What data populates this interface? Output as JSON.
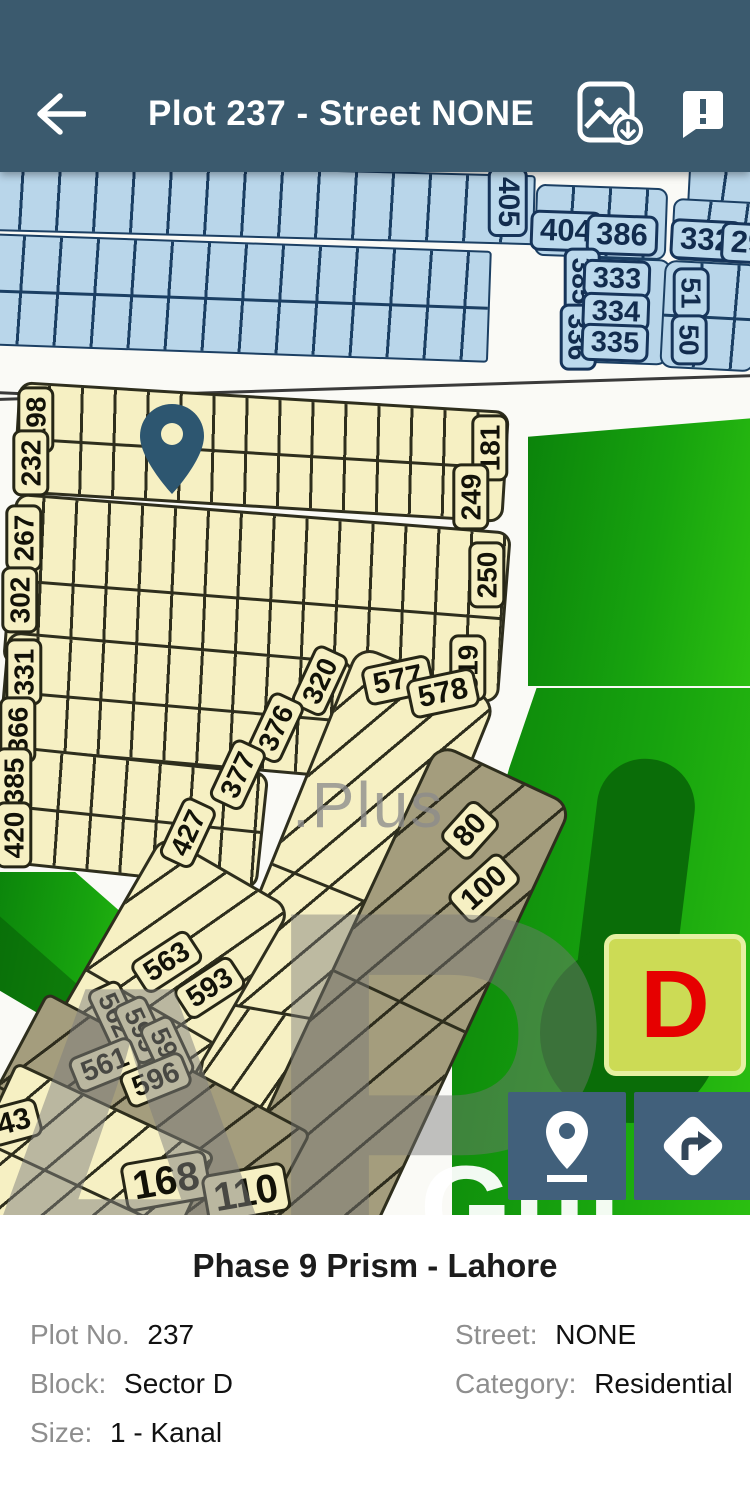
{
  "header": {
    "title": "Plot 237 - Street NONE",
    "icons": [
      "back-arrow",
      "save-map-image",
      "feedback"
    ]
  },
  "colors": {
    "appbar": "#3b5a6e",
    "blue_plot": "#b9d6ea",
    "cream_plot": "#f6f0c3",
    "grey_plot": "#a49d7d",
    "green_area": "#17a30e",
    "badge_bg": "#ccdb55",
    "badge_letter": "#e60000",
    "pin": "#2d5670",
    "button_bg": "#41607b"
  },
  "map": {
    "pin_color": "#2d5670",
    "watermark": {
      "letter_a": "A",
      "letter_p": "P",
      "text": ".Plus"
    },
    "green_area_text": "Gul",
    "sector_badge": {
      "label": "D"
    },
    "buttons": [
      {
        "name": "show-my-location",
        "icon": "map-pin-icon"
      },
      {
        "name": "directions",
        "icon": "turn-right-sign-icon"
      }
    ],
    "bands": [
      {
        "k": "blue",
        "x": -15,
        "y": -4,
        "w": 550,
        "h": 70,
        "rot": 1.5,
        "s": 92,
        "r": 4
      },
      {
        "k": "blue",
        "x": 688,
        "y": -6,
        "w": 70,
        "h": 46,
        "rot": 3,
        "s": 95,
        "r": 4
      },
      {
        "k": "blue",
        "x": 535,
        "y": 14,
        "w": 132,
        "h": 72,
        "rot": 2,
        "s": 92,
        "r": 10
      },
      {
        "k": "blue",
        "x": 672,
        "y": 28,
        "w": 85,
        "h": 62,
        "rot": 3,
        "s": 95,
        "r": 10
      },
      {
        "k": "blue",
        "x": -15,
        "y": 70,
        "w": 505,
        "h": 112,
        "rot": 2,
        "s": 92,
        "r": 4,
        "div": true
      },
      {
        "k": "blue",
        "x": 575,
        "y": 86,
        "w": 95,
        "h": 106,
        "rot": 2,
        "r": 12
      },
      {
        "k": "blue",
        "x": 662,
        "y": 90,
        "w": 95,
        "h": 108,
        "rot": 3,
        "s": 92,
        "r": 12,
        "div": true
      },
      {
        "k": "line",
        "x": -5,
        "y": 214,
        "w": 765,
        "h": 3,
        "rot": -1.8
      },
      {
        "k": "line",
        "x": -5,
        "y": 226,
        "w": 320,
        "h": 3,
        "rot": 2.5
      },
      {
        "k": "cream",
        "x": 15,
        "y": 224,
        "w": 492,
        "h": 112,
        "rot": 3.5,
        "s": 88,
        "r": 14,
        "div": true
      },
      {
        "k": "cream",
        "x": 8,
        "y": 340,
        "w": 498,
        "h": 172,
        "rot": 4.5,
        "s": 88,
        "r": 14,
        "div": true
      },
      {
        "k": "cream",
        "x": 2,
        "y": 474,
        "w": 348,
        "h": 118,
        "rot": 5,
        "s": 88,
        "r": 14,
        "div": true
      },
      {
        "k": "cream",
        "x": -8,
        "y": 586,
        "w": 272,
        "h": 118,
        "rot": 6,
        "s": 88,
        "r": 14,
        "div": true
      },
      {
        "k": "cream",
        "x": 265,
        "y": 483,
        "w": 150,
        "h": 470,
        "rot": 22,
        "s": 118,
        "r": 20,
        "div": true
      },
      {
        "k": "cream",
        "x": 190,
        "y": 838,
        "w": 140,
        "h": 240,
        "rot": 10,
        "s": 115,
        "r": 18,
        "div": true
      },
      {
        "k": "cream",
        "x": 75,
        "y": 678,
        "w": 150,
        "h": 310,
        "rot": 30,
        "s": 115,
        "r": 18,
        "div": true
      },
      {
        "k": "grey",
        "x": 325,
        "y": 578,
        "w": 150,
        "h": 500,
        "rot": 25,
        "s": 115,
        "r": 20,
        "div": true
      },
      {
        "k": "grey",
        "x": -20,
        "y": 878,
        "w": 300,
        "h": 210,
        "rot": 28,
        "s": 115,
        "r": 8,
        "div": true
      },
      {
        "k": "cream",
        "x": -30,
        "y": 928,
        "w": 220,
        "h": 170,
        "rot": 25,
        "s": 115,
        "r": 8,
        "div": true
      }
    ],
    "plots": [
      {
        "t": "405",
        "k": "blue",
        "x": 508,
        "y": 30,
        "rot": 90,
        "fs": 30
      },
      {
        "t": "404",
        "k": "blue",
        "x": 566,
        "y": 59,
        "rot": 2
      },
      {
        "t": "386",
        "k": "blue",
        "x": 622,
        "y": 63,
        "rot": 2
      },
      {
        "t": "332",
        "k": "blue",
        "x": 706,
        "y": 68,
        "rot": 3
      },
      {
        "t": "29",
        "k": "blue",
        "x": 748,
        "y": 71,
        "rot": 3
      },
      {
        "t": "385",
        "k": "blue",
        "x": 582,
        "y": 109,
        "rot": 90,
        "fs": 28
      },
      {
        "t": "336",
        "k": "blue",
        "x": 578,
        "y": 165,
        "rot": 90,
        "fs": 28
      },
      {
        "t": "333",
        "k": "blue",
        "x": 617,
        "y": 107,
        "rot": 2,
        "fs": 29
      },
      {
        "t": "334",
        "k": "blue",
        "x": 616,
        "y": 140,
        "rot": 2,
        "fs": 29
      },
      {
        "t": "335",
        "k": "blue",
        "x": 615,
        "y": 171,
        "rot": 2,
        "fs": 29
      },
      {
        "t": "51",
        "k": "blue",
        "x": 691,
        "y": 121,
        "rot": 90,
        "fs": 28
      },
      {
        "t": "50",
        "k": "blue",
        "x": 689,
        "y": 168,
        "rot": 90,
        "fs": 28
      },
      {
        "t": "198",
        "k": "cream",
        "x": 36,
        "y": 248,
        "rot": -90,
        "fs": 28
      },
      {
        "t": "232",
        "k": "cream",
        "x": 31,
        "y": 291,
        "rot": -90,
        "fs": 28
      },
      {
        "t": "181",
        "k": "cream",
        "x": 490,
        "y": 276,
        "rot": -90,
        "fs": 28
      },
      {
        "t": "249",
        "k": "cream",
        "x": 471,
        "y": 325,
        "rot": -90,
        "fs": 28
      },
      {
        "t": "267",
        "k": "cream",
        "x": 24,
        "y": 366,
        "rot": -90,
        "fs": 28
      },
      {
        "t": "302",
        "k": "cream",
        "x": 20,
        "y": 428,
        "rot": -90,
        "fs": 28
      },
      {
        "t": "250",
        "k": "cream",
        "x": 487,
        "y": 403,
        "rot": -90,
        "fs": 28
      },
      {
        "t": "319",
        "k": "cream",
        "x": 468,
        "y": 496,
        "rot": -90,
        "fs": 28
      },
      {
        "t": "331",
        "k": "cream",
        "x": 24,
        "y": 500,
        "rot": -90,
        "fs": 28
      },
      {
        "t": "366",
        "k": "cream",
        "x": 18,
        "y": 558,
        "rot": -90,
        "fs": 28
      },
      {
        "t": "320",
        "k": "cream",
        "x": 320,
        "y": 509,
        "rot": -65,
        "fs": 28
      },
      {
        "t": "376",
        "k": "cream",
        "x": 276,
        "y": 556,
        "rot": -65,
        "fs": 28
      },
      {
        "t": "385",
        "k": "cream",
        "x": 14,
        "y": 609,
        "rot": -90,
        "fs": 28
      },
      {
        "t": "420",
        "k": "cream",
        "x": 14,
        "y": 663,
        "rot": -90,
        "fs": 28
      },
      {
        "t": "377",
        "k": "cream",
        "x": 238,
        "y": 603,
        "rot": -65,
        "fs": 28
      },
      {
        "t": "427",
        "k": "cream",
        "x": 188,
        "y": 661,
        "rot": -65,
        "fs": 28
      },
      {
        "t": "577",
        "k": "cream",
        "x": 398,
        "y": 508,
        "rot": -12,
        "fs": 30
      },
      {
        "t": "578",
        "k": "cream",
        "x": 443,
        "y": 521,
        "rot": -12,
        "fs": 30
      },
      {
        "t": "80",
        "k": "cream",
        "x": 470,
        "y": 658,
        "rot": -48,
        "fs": 30
      },
      {
        "t": "100",
        "k": "cream",
        "x": 484,
        "y": 716,
        "rot": -42,
        "fs": 30
      },
      {
        "t": "563",
        "k": "cream",
        "x": 167,
        "y": 790,
        "rot": -33,
        "fs": 29
      },
      {
        "t": "593",
        "k": "cream",
        "x": 210,
        "y": 816,
        "rot": -33,
        "fs": 29
      },
      {
        "t": "562",
        "k": "cream",
        "x": 115,
        "y": 843,
        "rot": 65,
        "fs": 27
      },
      {
        "t": "595",
        "k": "cream",
        "x": 141,
        "y": 858,
        "rot": 65,
        "fs": 27
      },
      {
        "t": "594",
        "k": "cream",
        "x": 167,
        "y": 878,
        "rot": 65,
        "fs": 27
      },
      {
        "t": "561",
        "k": "cream",
        "x": 105,
        "y": 893,
        "rot": -22,
        "fs": 29
      },
      {
        "t": "596",
        "k": "cream",
        "x": 156,
        "y": 908,
        "rot": -22,
        "fs": 29
      },
      {
        "t": "43",
        "k": "cream",
        "x": 14,
        "y": 950,
        "rot": -15,
        "fs": 30
      },
      {
        "t": "168",
        "k": "cream",
        "x": 166,
        "y": 1009,
        "rot": -10,
        "fs": 40
      },
      {
        "t": "110",
        "k": "cream",
        "x": 246,
        "y": 1021,
        "rot": -10,
        "fs": 40
      }
    ]
  },
  "details": {
    "title": "Phase 9 Prism - Lahore",
    "fields": [
      {
        "label": "Plot No.",
        "value": "237"
      },
      {
        "label": "Street:",
        "value": "NONE"
      },
      {
        "label": "Block:",
        "value": "Sector D"
      },
      {
        "label": "Category:",
        "value": "Residential"
      },
      {
        "label": "Size:",
        "value": "1 - Kanal"
      }
    ]
  }
}
